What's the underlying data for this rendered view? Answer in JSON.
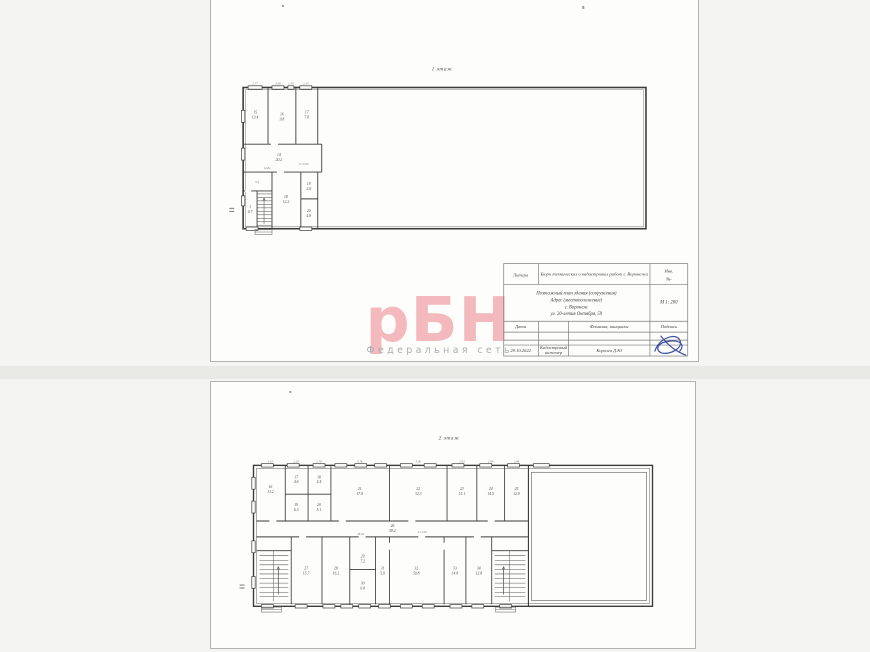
{
  "colors": {
    "canvas_bg": "#f4f4f2",
    "page_bg": "#fdfdfc",
    "wall": "#3c3c3c",
    "watermark_pink": "#f3b9bd",
    "caption_gray": "#a9aeb2",
    "signature_blue": "#3f51a3"
  },
  "page1": {
    "floor_title": "1 этаж",
    "watermark": {
      "logo": "рБН",
      "caption": "Федеральная сеть"
    },
    "stamp": {
      "litera_label": "Литера",
      "org": "Бюро технических и кадастровых работ г. Воронежа",
      "inv_line1": "Инв.",
      "inv_line2": "№-",
      "title_line1": "Поэтажный план здания (сооружения)",
      "title_line2": "Адрес (местоположение)",
      "title_line3": "г. Воронеж",
      "title_line4": "ул. 20-летия Октября, 59",
      "scale": "М 1: 200",
      "date_label": "Дата",
      "name_label": "Фамилия, инициалы",
      "sign_label": "Подпись",
      "date_value": "29.10.2022",
      "role_line1": "Кадастровый",
      "role_line2": "инженер",
      "name_value": "Королев Д.Ю"
    },
    "plan_labels": [
      {
        "x": 44,
        "y": 92,
        "t": "2.77",
        "c": "dim"
      },
      {
        "x": 67,
        "y": 92,
        "t": "3.08",
        "c": "dim"
      },
      {
        "x": 80,
        "y": 92,
        "t": "1.50",
        "c": "dim"
      },
      {
        "x": 95,
        "y": 92,
        "t": "2.45",
        "c": "dim"
      },
      {
        "x": 44,
        "y": 121,
        "t": "15"
      },
      {
        "x": 44,
        "y": 126,
        "t": "13.4"
      },
      {
        "x": 71,
        "y": 123,
        "t": "16"
      },
      {
        "x": 71,
        "y": 128,
        "t": "9.8"
      },
      {
        "x": 96,
        "y": 121,
        "t": "17"
      },
      {
        "x": 96,
        "y": 126,
        "t": "7.8"
      },
      {
        "x": 68,
        "y": 164,
        "t": "14"
      },
      {
        "x": 68,
        "y": 169,
        "t": "20.2"
      },
      {
        "x": 93,
        "y": 173,
        "t": "h=3.00",
        "c": "dim"
      },
      {
        "x": 56,
        "y": 177,
        "t": "12.84",
        "c": "dim"
      },
      {
        "x": 75,
        "y": 206,
        "t": "18"
      },
      {
        "x": 75,
        "y": 211,
        "t": "12.2"
      },
      {
        "x": 98,
        "y": 193,
        "t": "19"
      },
      {
        "x": 98,
        "y": 198,
        "t": "2.0"
      },
      {
        "x": 98,
        "y": 220,
        "t": "20"
      },
      {
        "x": 98,
        "y": 225,
        "t": "4.8"
      },
      {
        "x": 39,
        "y": 216,
        "t": "1"
      },
      {
        "x": 39,
        "y": 221,
        "t": "4.7"
      },
      {
        "x": 46,
        "y": 191,
        "t": "5.9",
        "c": "dim"
      }
    ]
  },
  "page2": {
    "floor_title": "2 этаж",
    "plan_labels": [
      {
        "x": 59,
        "y": 81,
        "t": "4.10",
        "c": "dim"
      },
      {
        "x": 85,
        "y": 81,
        "t": "2.28",
        "c": "dim"
      },
      {
        "x": 108,
        "y": 81,
        "t": "2.70",
        "c": "dim"
      },
      {
        "x": 149,
        "y": 81,
        "t": "5.78",
        "c": "dim"
      },
      {
        "x": 208,
        "y": 81,
        "t": "5.90",
        "c": "dim"
      },
      {
        "x": 252,
        "y": 81,
        "t": "2.93",
        "c": "dim"
      },
      {
        "x": 281,
        "y": 81,
        "t": "2.96",
        "c": "dim"
      },
      {
        "x": 307,
        "y": 81,
        "t": "2.98",
        "c": "dim"
      },
      {
        "x": 59,
        "y": 107,
        "t": "16"
      },
      {
        "x": 59,
        "y": 112,
        "t": "13.2"
      },
      {
        "x": 85,
        "y": 97,
        "t": "17"
      },
      {
        "x": 85,
        "y": 102,
        "t": "4.6"
      },
      {
        "x": 108,
        "y": 97,
        "t": "18"
      },
      {
        "x": 108,
        "y": 102,
        "t": "4.4"
      },
      {
        "x": 85,
        "y": 125,
        "t": "19"
      },
      {
        "x": 85,
        "y": 130,
        "t": "6.3"
      },
      {
        "x": 108,
        "y": 125,
        "t": "20"
      },
      {
        "x": 108,
        "y": 130,
        "t": "5.1"
      },
      {
        "x": 149,
        "y": 109,
        "t": "21"
      },
      {
        "x": 149,
        "y": 114,
        "t": "17.8"
      },
      {
        "x": 208,
        "y": 109,
        "t": "22"
      },
      {
        "x": 208,
        "y": 114,
        "t": "32.3"
      },
      {
        "x": 252,
        "y": 109,
        "t": "23"
      },
      {
        "x": 252,
        "y": 114,
        "t": "15.1"
      },
      {
        "x": 281,
        "y": 109,
        "t": "24"
      },
      {
        "x": 281,
        "y": 114,
        "t": "14.5"
      },
      {
        "x": 307,
        "y": 109,
        "t": "25"
      },
      {
        "x": 307,
        "y": 114,
        "t": "12.9"
      },
      {
        "x": 182,
        "y": 146,
        "t": "26"
      },
      {
        "x": 182,
        "y": 151,
        "t": "58.2"
      },
      {
        "x": 212,
        "y": 152,
        "t": "h=3.00",
        "c": "dim"
      },
      {
        "x": 150,
        "y": 154,
        "t": "28.94",
        "c": "dim"
      },
      {
        "x": 95,
        "y": 189,
        "t": "27"
      },
      {
        "x": 95,
        "y": 194,
        "t": "15.7"
      },
      {
        "x": 125,
        "y": 189,
        "t": "28"
      },
      {
        "x": 125,
        "y": 194,
        "t": "16.2"
      },
      {
        "x": 152,
        "y": 177,
        "t": "29"
      },
      {
        "x": 152,
        "y": 182,
        "t": "7.2"
      },
      {
        "x": 152,
        "y": 204,
        "t": "30"
      },
      {
        "x": 152,
        "y": 209,
        "t": "6.8"
      },
      {
        "x": 172,
        "y": 189,
        "t": "31"
      },
      {
        "x": 172,
        "y": 194,
        "t": "5.9"
      },
      {
        "x": 206,
        "y": 189,
        "t": "32"
      },
      {
        "x": 206,
        "y": 194,
        "t": "50.8"
      },
      {
        "x": 245,
        "y": 189,
        "t": "33"
      },
      {
        "x": 245,
        "y": 194,
        "t": "14.8"
      },
      {
        "x": 269,
        "y": 189,
        "t": "34"
      },
      {
        "x": 269,
        "y": 194,
        "t": "12.8"
      }
    ]
  }
}
